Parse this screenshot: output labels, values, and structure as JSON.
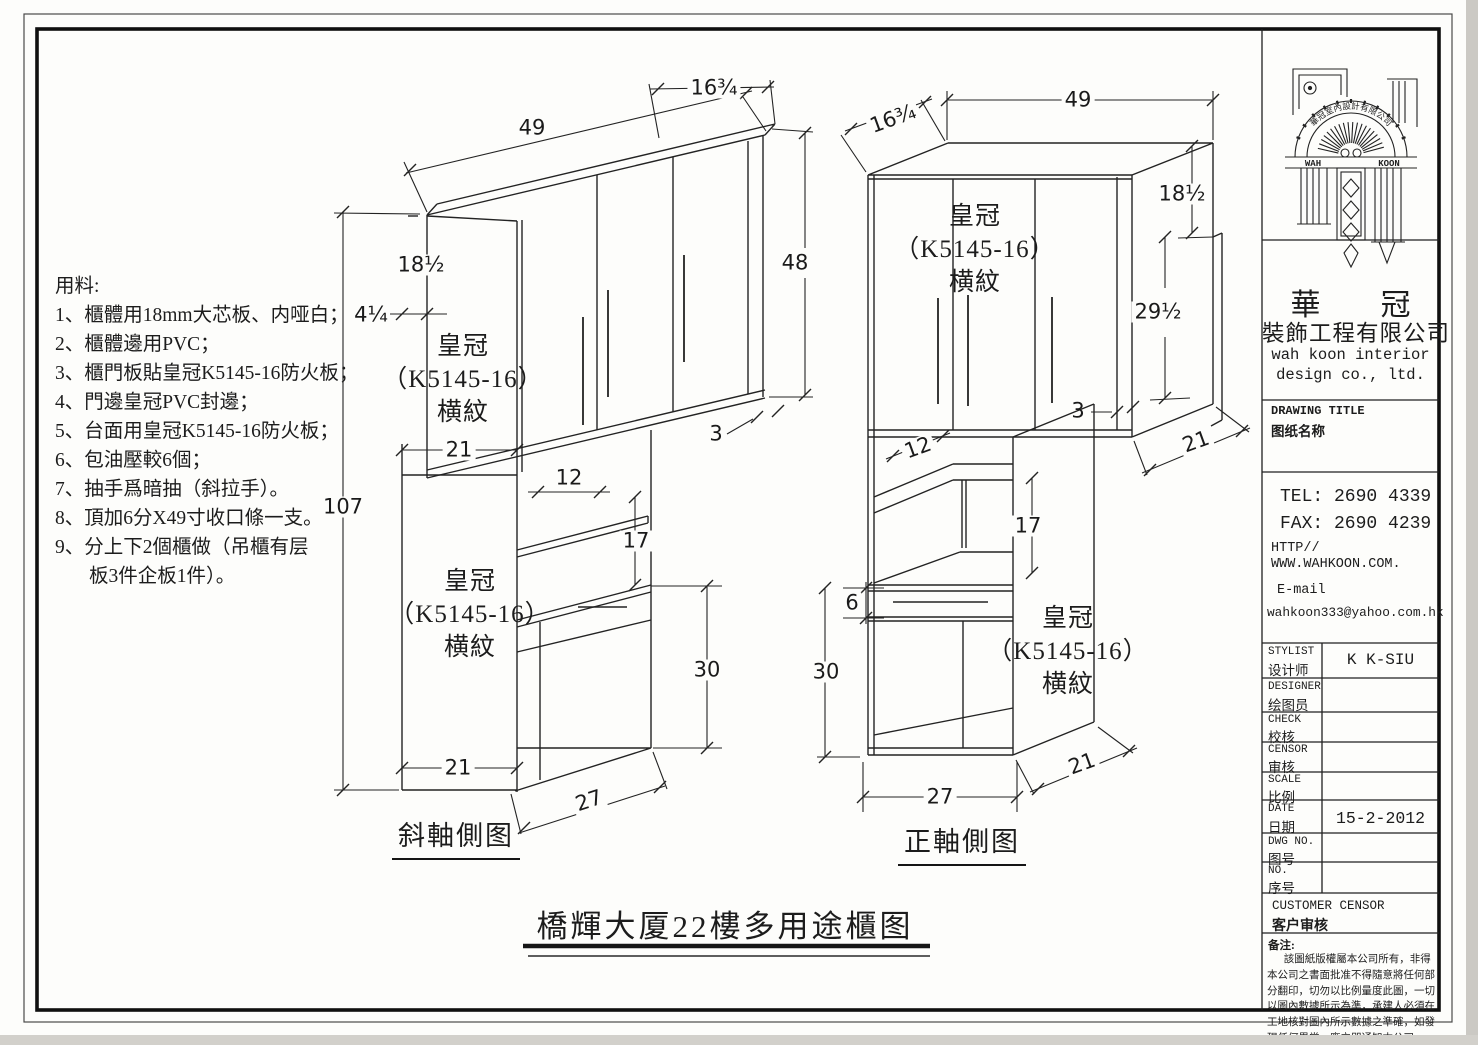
{
  "sheet": {
    "title": "橋輝大厦22樓多用途櫃图"
  },
  "materials": {
    "heading": "用料:",
    "items": [
      "1、櫃體用18mm大芯板、内哑白；",
      "2、櫃體邊用PVC；",
      "3、櫃門板貼皇冠K5145-16防火板；",
      "4、門邊皇冠PVC封邊；",
      "5、台面用皇冠K5145-16防火板；",
      "6、包油壓較6個；",
      "7、抽手爲暗抽（斜拉手）。",
      "8、頂加6分X49寸收口條一支。",
      "9、分上下2個櫃做（吊櫃有层",
      "板3件企板1件）。"
    ]
  },
  "views": {
    "left_label": "斜軸側图",
    "right_label": "正軸側图"
  },
  "panel": {
    "l1": "皇冠",
    "l2": "（K5145-16）",
    "l3": "横紋"
  },
  "dims": {
    "n49": "49",
    "n16q": "16¾",
    "n18h": "18½",
    "n4q": "4¼",
    "n107": "107",
    "n48": "48",
    "n3": "3",
    "n21": "21",
    "n12": "12",
    "n17": "17",
    "n30": "30",
    "n27": "27",
    "n29h": "29½",
    "n6": "6"
  },
  "titleblock": {
    "logo": {
      "arc": "華冠室內設計有限公司",
      "wah": "WAH",
      "koon": "KOON"
    },
    "company": {
      "cn_top": "華　　冠",
      "cn_sub": "裝飾工程有限公司",
      "en1": "wah koon interior",
      "en2": "design co., ltd."
    },
    "drawing_title": {
      "en": "DRAWING TITLE",
      "cn": "图纸名称"
    },
    "contact": {
      "tel": "TEL: 2690 4339",
      "fax": "FAX: 2690 4239",
      "http": "HTTP//",
      "www": "WWW.WAHKOON.COM.",
      "email_label": "E-mail",
      "email": "wahkoon333@yahoo.com.hk"
    },
    "rows": [
      {
        "en": "STYLIST",
        "cn": "设计师",
        "value": "K K-SIU"
      },
      {
        "en": "DESIGNER",
        "cn": "绘图员",
        "value": ""
      },
      {
        "en": "CHECK",
        "cn": "校核",
        "value": ""
      },
      {
        "en": "CENSOR",
        "cn": "审核",
        "value": ""
      },
      {
        "en": "SCALE",
        "cn": "比例",
        "value": ""
      },
      {
        "en": "DATE",
        "cn": "日期",
        "value": "15-2-2012"
      },
      {
        "en": "DWG NO.",
        "cn": "图号",
        "value": ""
      },
      {
        "en": "NO.",
        "cn": "序号",
        "value": ""
      }
    ],
    "customer": {
      "en": "CUSTOMER CENSOR",
      "cn": "客户审核"
    },
    "notes": {
      "label": "备注:",
      "body": "該圖紙版權屬本公司所有，非得本公司之書面批准不得隨意將任何部分翻印，切勿以比例量度此圖，一切以圖內數據所示為準，承建人必須在工地核對圖內所示數據之準確，如發現任何異常，應立即通知本公司。"
    }
  }
}
